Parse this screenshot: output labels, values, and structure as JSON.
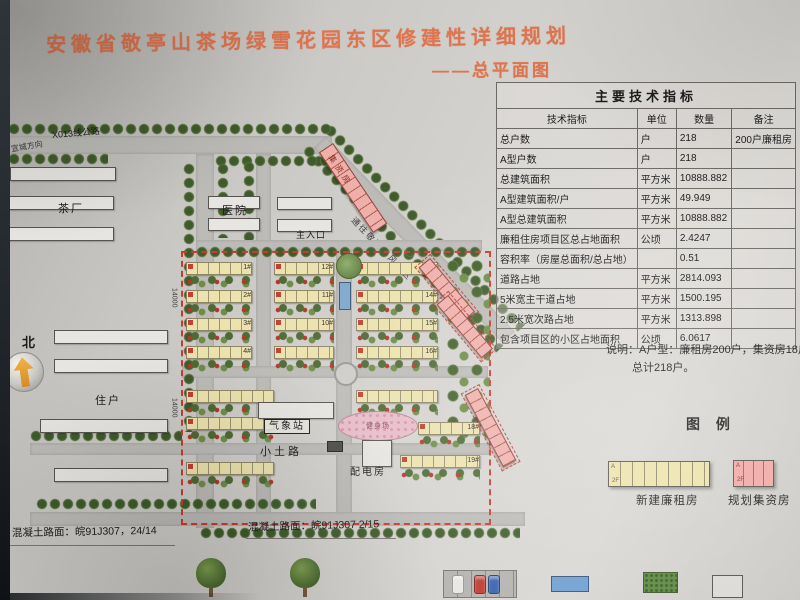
{
  "title": "安徽省敬亭山茶场绿雪花园东区修建性详细规划",
  "subtitle": "——总平面图",
  "north_label": "北",
  "tech_table": {
    "title": "主要技术指标",
    "headers": [
      "技术指标",
      "单位",
      "数量",
      "备注"
    ],
    "rows": [
      {
        "indicator": "总户数",
        "unit": "户",
        "quantity": "218",
        "remark": "200户廉租房"
      },
      {
        "indicator": "A型户数",
        "unit": "户",
        "quantity": "218",
        "remark": ""
      },
      {
        "indicator": "总建筑面积",
        "unit": "平方米",
        "quantity": "10888.882",
        "remark": ""
      },
      {
        "indicator": "A型建筑面积/户",
        "unit": "平方米",
        "quantity": "49.949",
        "remark": ""
      },
      {
        "indicator": "A型总建筑面积",
        "unit": "平方米",
        "quantity": "10888.882",
        "remark": ""
      },
      {
        "indicator": "廉租住房项目区总占地面积",
        "unit": "公顷",
        "quantity": "2.4247",
        "remark": ""
      },
      {
        "indicator": "容积率（房屋总面积/总占地）",
        "unit": "",
        "quantity": "0.51",
        "remark": ""
      },
      {
        "indicator": "道路占地",
        "unit": "平方米",
        "quantity": "2814.093",
        "remark": ""
      },
      {
        "indicator": "5米宽主干道占地",
        "unit": "平方米",
        "quantity": "1500.195",
        "remark": ""
      },
      {
        "indicator": "2.5米宽次路占地",
        "unit": "平方米",
        "quantity": "1313.898",
        "remark": ""
      },
      {
        "indicator": "包含项目区的小区占地面积",
        "unit": "公顷",
        "quantity": "6.0617",
        "remark": ""
      }
    ],
    "note_line1": "说明：A户型：廉租房200户，集资房18户。",
    "note_line2": "总计218户。"
  },
  "legend": {
    "title": "图  例",
    "items": [
      {
        "label": "新建廉租房"
      },
      {
        "label": "规划集资房"
      }
    ],
    "unit_type_mark": "A",
    "floor_mark": "2F"
  },
  "plan": {
    "labels": {
      "road_top": "X013线公路",
      "direction": "宣城方向",
      "tea_factory": "茶厂",
      "hospital": "医院",
      "residents": "住户",
      "main_entrance": "主入口",
      "weather_station": "气象站",
      "dirt_road": "小土路",
      "power_room": "配电房",
      "fitness": "健身场",
      "scenic_road": "通往敬亭山风景区",
      "jizifang": "集资房",
      "dim1": "14000",
      "dim2": "14000"
    },
    "building_numbers": [
      "1#",
      "2#",
      "3#",
      "4#",
      "12#",
      "11#",
      "10#",
      "13#",
      "14#",
      "15#",
      "16#",
      "18#",
      "19#"
    ]
  },
  "footer": {
    "left_spec": "混凝土路面：皖91J307，24/14",
    "center_spec": "混凝土路面：皖91J307 2/15"
  },
  "colors": {
    "title_accent": "#dd7550",
    "lowrent_yellow": "#ece2ae",
    "jizi_pink": "#efb0ac",
    "boundary_red": "#cc3a2e",
    "tree_green": "#55713a"
  }
}
